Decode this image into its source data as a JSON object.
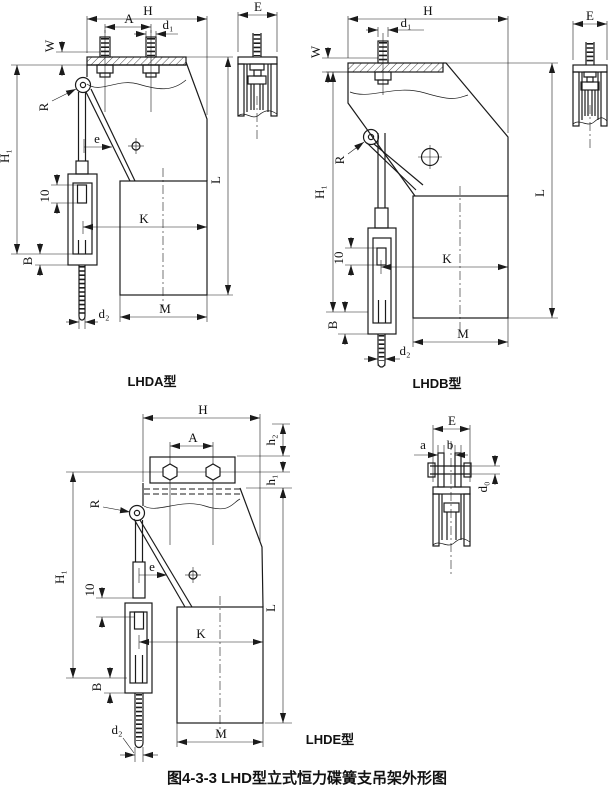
{
  "caption": "图4-3-3  LHD型立式恒力碟簧支吊架外形图",
  "drawings": {
    "lhda": {
      "type_label": "LHDA型",
      "dims": {
        "H": "H",
        "A": "A",
        "d1": "d₁",
        "W": "W",
        "E": "E",
        "R": "R",
        "e": "e",
        "H1": "H₁",
        "len10": "10",
        "B": "B",
        "d2": "d₂",
        "K": "K",
        "M": "M",
        "L": "L"
      }
    },
    "lhdb": {
      "type_label": "LHDB型",
      "dims": {
        "H": "H",
        "d1": "d₁",
        "W": "W",
        "E": "E",
        "R": "R",
        "H1": "H₁",
        "len10": "10",
        "B": "B",
        "d2": "d₂",
        "K": "K",
        "M": "M",
        "L": "L"
      }
    },
    "lhde": {
      "type_label": "LHDE型",
      "dims": {
        "H": "H",
        "A": "A",
        "h2": "h₂",
        "h1": "h₁",
        "E": "E",
        "a": "a",
        "b": "b",
        "d0": "d₀",
        "R": "R",
        "e": "e",
        "H1": "H₁",
        "len10": "10",
        "B": "B",
        "d2": "d₂",
        "K": "K",
        "M": "M",
        "L": "L"
      }
    }
  }
}
